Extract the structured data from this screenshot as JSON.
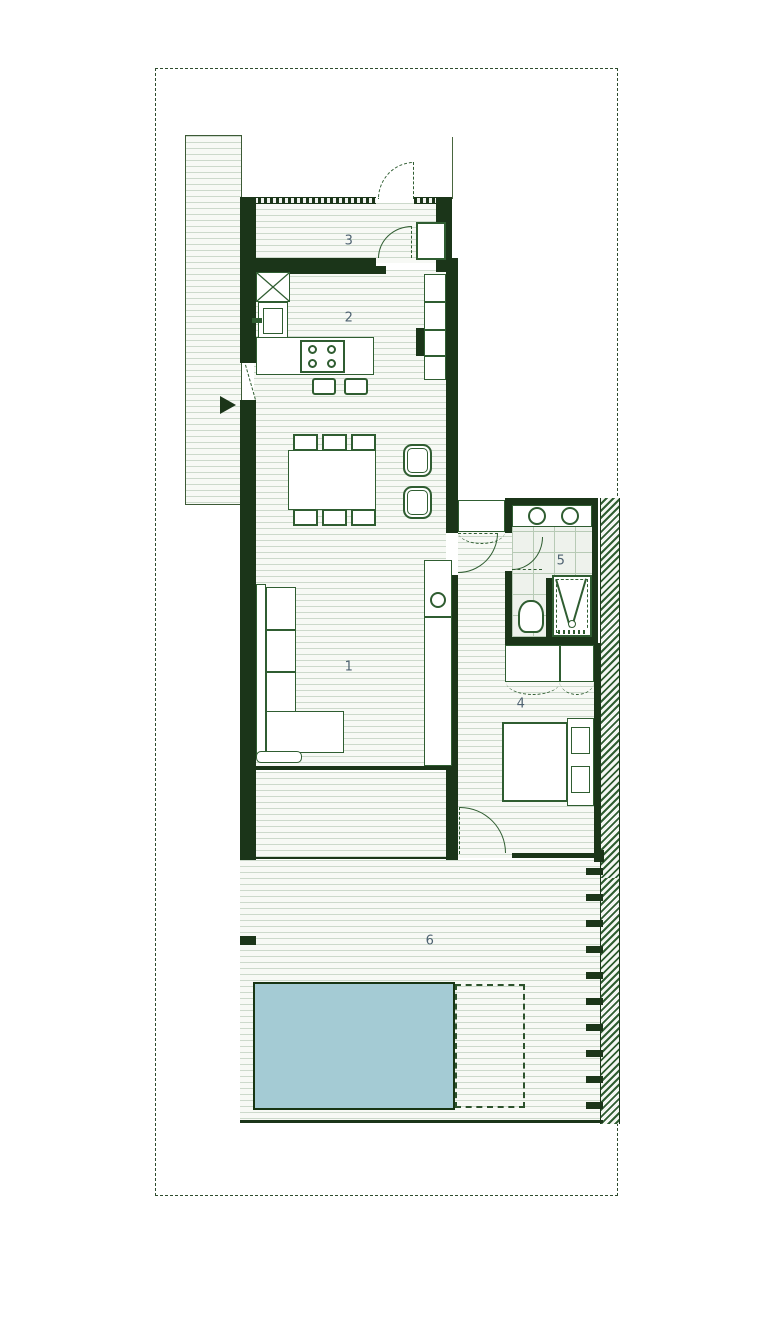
{
  "plan": {
    "kind": "architectural-floor-plan",
    "rooms": [
      {
        "label": "1"
      },
      {
        "label": "2"
      },
      {
        "label": "3"
      },
      {
        "label": "4"
      },
      {
        "label": "5"
      },
      {
        "label": "6"
      }
    ]
  },
  "colors": {
    "wall": "#1b3519",
    "furniture_line": "#2f5d31",
    "floor_hatch_line": "#ccd9cb",
    "tile_line": "#b7cab5",
    "pool_fill": "#a4cbd4",
    "pool_border": "#173513",
    "label_text": "#4e6271",
    "site_boundary": "#2e4d2e",
    "hatch_diagonal": "#2f5d31"
  }
}
